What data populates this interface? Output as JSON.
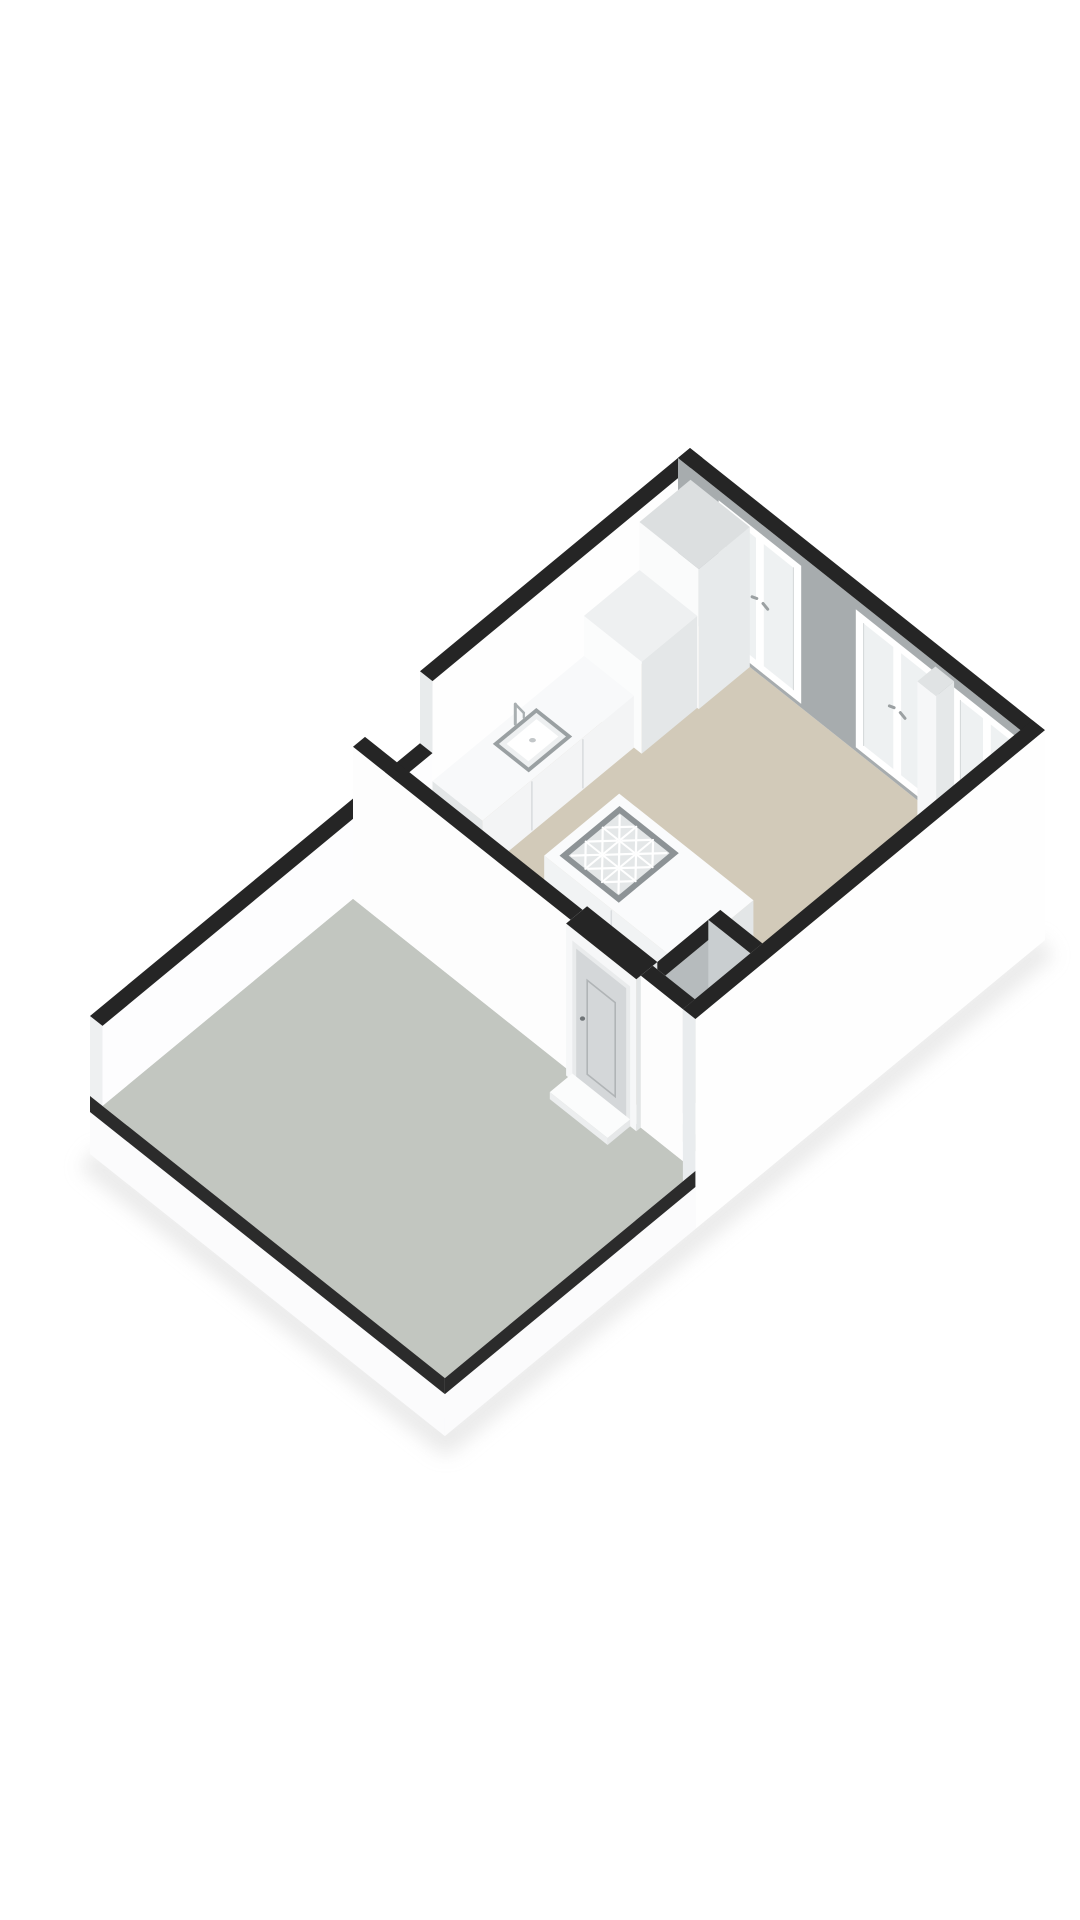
{
  "document": {
    "kind": "3d-floorplan-render",
    "background_color": "#ffffff",
    "view": "isometric"
  },
  "rooms": [
    {
      "name": "living-kitchen",
      "floor_color": "#d2cab9"
    },
    {
      "name": "terrace",
      "floor_color": "#c2c6c0"
    },
    {
      "name": "entry-closet",
      "floor_color": "#c8cbc6"
    }
  ],
  "fixtures": [
    "kitchen-counter",
    "kitchen-sink",
    "kitchen-faucet",
    "kitchen-tall-cabinet",
    "kitchen-mid-cabinet",
    "kitchen-low-cabinet",
    "kitchen-island",
    "island-cooktop",
    "structural-column",
    "entrance-door",
    "door-threshold",
    "french-window-1",
    "french-window-2",
    "french-window-3",
    "closet-unit"
  ],
  "palette": {
    "wall_cap": "#252525",
    "wall_white": "#fdfdfd",
    "wall_shade": "#e9eced",
    "ne_wall_grey": "#a7acae",
    "floor_beige": "#d2cab9",
    "floor_terrace": "#c2c6c0",
    "glass": "#eef1f2",
    "frame": "#ffffff",
    "door_leaf": "#d4d7d9",
    "slab_edge_dark": "#2b2b2b",
    "plinth": "#fbfbfc"
  },
  "projection": {
    "ox": 690,
    "oy": 600,
    "d1x": -0.75,
    "d1y": 0.62,
    "d2x": 0.78,
    "d2y": 0.62
  },
  "scene": [
    {
      "type": "shadow",
      "name": "ground-shadow",
      "pts": [
        [
          88,
          1158
        ],
        [
          446,
          1441
        ],
        [
          1046,
          946
        ]
      ],
      "width": 26,
      "color": "#d9d9d9",
      "opacity": 0.55
    },
    {
      "type": "floor",
      "name": "floor-living-kitchen",
      "u1": 16,
      "v1": 16,
      "u2": 450,
      "v2": 439,
      "color": "#d2cab9"
    },
    {
      "type": "floor",
      "name": "floor-closet",
      "u1": 376,
      "v1": 401,
      "u2": 450,
      "v2": 439,
      "color": "#c8cbc6"
    },
    {
      "type": "floor",
      "name": "floor-terrace",
      "u1": 466,
      "v1": 16,
      "u2": 800,
      "v2": 455,
      "color": "#c2c6c0"
    },
    {
      "type": "box",
      "name": "wall-northwest",
      "u1": 0,
      "v1": 0,
      "u2": 360,
      "v2": 16,
      "z0": 0,
      "h": 152,
      "top": "#252525",
      "sw": "#e8ebec",
      "se": "#fefefe"
    },
    {
      "type": "box",
      "name": "wall-northwest-parapet",
      "u1": 360,
      "v1": 0,
      "u2": 800,
      "v2": 16,
      "z0": 0,
      "h": 80,
      "top": "#252525",
      "sw": "#eef0f1",
      "se": "#fdfdfe"
    },
    {
      "type": "ne_wall",
      "name": "wall-northeast",
      "u1": 0,
      "v1": 0,
      "u2": 16,
      "v2": 455,
      "h": 152,
      "grey": "#a7acae",
      "cap": "#252525"
    },
    {
      "type": "window",
      "name": "french-window-1",
      "v1": 52,
      "v2": 158,
      "h": 152,
      "frame": "#ffffff",
      "glass": "#eef1f2",
      "handle": "#9ba0a2"
    },
    {
      "type": "window",
      "name": "french-window-2",
      "v1": 228,
      "v2": 334,
      "h": 152,
      "frame": "#ffffff",
      "glass": "#eef1f2",
      "handle": "#9ba0a2"
    },
    {
      "type": "window",
      "name": "french-window-3",
      "v1": 352,
      "v2": 440,
      "h": 152,
      "frame": "#ffffff",
      "glass": "#eef1f2",
      "handle": "#9ba0a2"
    },
    {
      "type": "box",
      "name": "kitchen-tall-cabinet",
      "u1": 16,
      "v1": 16,
      "u2": 84,
      "v2": 92,
      "z0": 0,
      "h": 140,
      "top": "#dcdfe0",
      "sw": "#fafbfb",
      "se": "#e7eaeb"
    },
    {
      "type": "box",
      "name": "kitchen-mid-cabinet",
      "u1": 84,
      "v1": 16,
      "u2": 158,
      "v2": 90,
      "z0": 0,
      "h": 92,
      "top": "#eef0f1",
      "sw": "#fbfcfc",
      "se": "#e4e7e8"
    },
    {
      "type": "box",
      "name": "kitchen-counter",
      "u1": 158,
      "v1": 16,
      "u2": 360,
      "v2": 80,
      "z0": 0,
      "h": 52,
      "top": "#f8f9fa",
      "sw": "#e3e6e7",
      "se": "#f3f4f5",
      "seams": {
        "face": "se",
        "at": [
          226,
          294
        ],
        "color": "#d8dbdd"
      }
    },
    {
      "type": "sink",
      "name": "kitchen-sink",
      "u1": 232,
      "v1": 26,
      "u2": 290,
      "v2": 72,
      "z": 52,
      "rim": "#9aa0a2",
      "inner": "#eef0f1",
      "basin": "#ffffff",
      "drain": "#c2c6c8"
    },
    {
      "type": "faucet",
      "name": "kitchen-faucet",
      "u": 259,
      "v": 25,
      "z": 52,
      "color": "#a9afb1"
    },
    {
      "type": "box",
      "name": "kitchen-low-cabinet",
      "u1": 366,
      "v1": 16,
      "u2": 436,
      "v2": 82,
      "z0": 0,
      "h": 30,
      "top": "#f2f3f4",
      "sw": "#e2e5e6",
      "se": "#eff1f2"
    },
    {
      "type": "box",
      "name": "wall-column-northeast",
      "u1": 16,
      "v1": 330,
      "u2": 40,
      "v2": 354,
      "z0": 0,
      "h": 148,
      "top": "#e0e3e4",
      "sw": "#f6f7f8",
      "se": "#e5e8e9"
    },
    {
      "type": "box",
      "name": "kitchen-island",
      "u1": 240,
      "v1": 140,
      "u2": 340,
      "v2": 312,
      "z0": 0,
      "h": 42,
      "top": "#fafbfc",
      "sw": "#f1f3f4",
      "se": "#e3e6e7",
      "seams": {
        "face": "sw",
        "at": [
          226
        ],
        "color": "#dadde0"
      }
    },
    {
      "type": "cooktop",
      "name": "island-cooktop",
      "u1": 250,
      "v1": 150,
      "u2": 330,
      "v2": 226,
      "z": 42,
      "rim": "#8d9396",
      "field": "#e4e7e8",
      "line": "#ffffff"
    },
    {
      "type": "box",
      "name": "closet-unit",
      "u1": 382,
      "v1": 405,
      "u2": 436,
      "v2": 437,
      "z0": 0,
      "h": 86,
      "top": "#e5e8e9",
      "sw": "#eff1f2",
      "se": "#e0e3e4"
    },
    {
      "type": "box",
      "name": "closet-wall-rear",
      "u1": 376,
      "v1": 385,
      "u2": 450,
      "v2": 401,
      "z0": 0,
      "h": 152,
      "top": "#252525",
      "sw": "#d4d7d9",
      "se": "#b6bbbd"
    },
    {
      "type": "box",
      "name": "closet-wall-northeast",
      "u1": 360,
      "v1": 385,
      "u2": 376,
      "v2": 439,
      "z0": 0,
      "h": 152,
      "top": "#252525",
      "sw": "#c9ced0",
      "se": "#c0c5c7"
    },
    {
      "type": "box",
      "name": "wall-divider",
      "u1": 450,
      "v1": 16,
      "u2": 466,
      "v2": 295,
      "z0": 0,
      "h": 152,
      "top": "#252525",
      "sw": "#fdfdfd",
      "se": "#e6e9ea"
    },
    {
      "type": "door_block",
      "name": "entrance-door",
      "u1": 444,
      "v1": 295,
      "u2": 472,
      "v2": 385,
      "h": 152,
      "top": "#252525",
      "face": "#f6f7f8",
      "frame": "#e9ebec",
      "leaf": "#d4d7d9",
      "panel": "#b0b4b6",
      "handle": "#6f7477",
      "se": "#e2e5e6"
    },
    {
      "type": "box",
      "name": "closet-wall-southwest",
      "u1": 450,
      "v1": 385,
      "u2": 466,
      "v2": 439,
      "z0": 0,
      "h": 152,
      "top": "#252525",
      "sw": "#fdfdfd",
      "se": "#e6e9ea"
    },
    {
      "type": "box",
      "name": "door-threshold",
      "u1": 472,
      "v1": 303,
      "u2": 502,
      "v2": 377,
      "z0": 0,
      "h": 7,
      "top": "#fbfcfc",
      "sw": "#eceeef",
      "se": "#e6e8e9"
    },
    {
      "type": "box",
      "name": "wall-southeast",
      "u1": 0,
      "v1": 439,
      "u2": 466,
      "v2": 455,
      "z0": -58,
      "h": 210,
      "top": "#252525",
      "sw": "#e9ecee",
      "se": "#fefefe"
    },
    {
      "type": "slab_edge",
      "name": "terrace-edge-southwest",
      "plane": "sw",
      "u": 800,
      "v1": 0,
      "v2": 455,
      "dark": "#2b2b2b",
      "light": "#fbfbfc"
    },
    {
      "type": "slab_edge",
      "name": "terrace-edge-southeast",
      "plane": "se",
      "v": 455,
      "u1": 466,
      "u2": 800,
      "dark": "#2b2b2b",
      "light": "#fbfbfc"
    }
  ]
}
